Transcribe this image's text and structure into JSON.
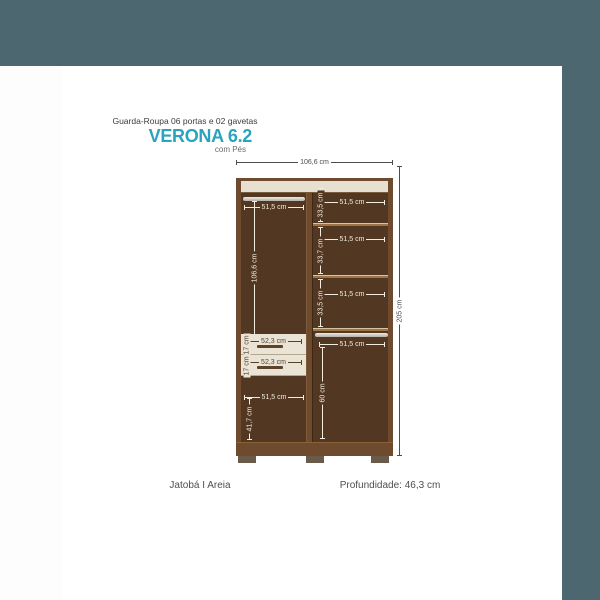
{
  "header": {
    "product_type": "Guarda-Roupa 06 portas e 02 gavetas",
    "product_name": "VERONA 6.2",
    "variant": "com Pés"
  },
  "wardrobe": {
    "overall": {
      "width": "106,6 cm",
      "height": "205 cm"
    },
    "left_column": {
      "rod_width": "51,5 cm",
      "hanging_height": "106,6 cm",
      "drawer1": {
        "width": "52,3 cm",
        "height": "17 cm"
      },
      "drawer2": {
        "width": "52,3 cm",
        "height": "17 cm"
      },
      "bottom_section": {
        "width": "51,5 cm",
        "height": "41,7 cm"
      }
    },
    "right_column": {
      "section1": {
        "width": "51,5 cm",
        "height": "33,5 cm"
      },
      "section2": {
        "width": "51,5 cm",
        "height": "33,7 cm"
      },
      "section3": {
        "width": "51,5 cm",
        "height": "33,5 cm"
      },
      "section4": {
        "width": "51,5 cm",
        "height": "60 cm"
      }
    }
  },
  "footer": {
    "finish": "Jatobá I Areia",
    "depth": "Profundidade: 46,3 cm"
  },
  "colors": {
    "band": "#4d6770",
    "accent": "#2aa3bc",
    "wood": "#6e4b2f",
    "woodDark": "#523722",
    "beige": "#e7dfcf",
    "drawer": "#eae4d7",
    "rod": "#d6d2ca"
  }
}
